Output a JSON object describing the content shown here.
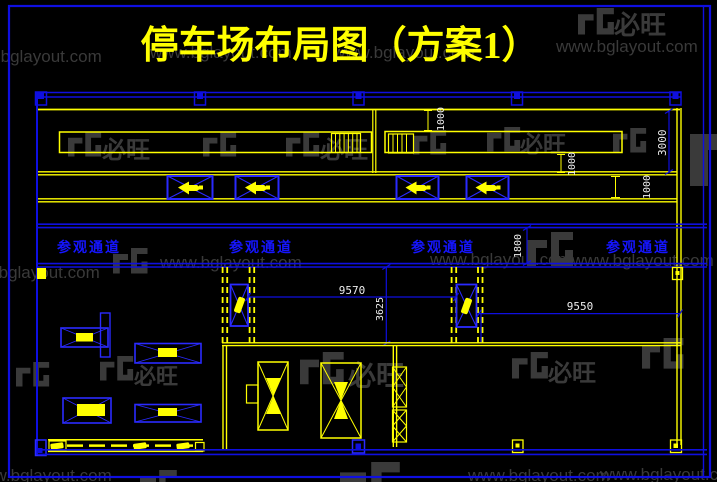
{
  "title": "停车场布局图（方案1）",
  "watermark": {
    "url": "www.bglayout.com",
    "brand": "必旺"
  },
  "labels": {
    "corridor": "参观通道"
  },
  "dims": {
    "stair_gap": "1000",
    "bay_right": "1000",
    "bay_road": "1000",
    "right_height": "3000",
    "corridor_width": "1800",
    "span_left": "9570",
    "bay_depth": "3625",
    "span_right": "9550"
  },
  "colors": {
    "background": "#000000",
    "line_blue": "#0f0fe0",
    "accent_blue": "#2a2aff",
    "stall_fill": "#000080",
    "line_yellow": "#ffff00",
    "dim_text": "#ededed",
    "corridor_text": "#1515ff",
    "watermark_gray": "#3a3a3a"
  }
}
